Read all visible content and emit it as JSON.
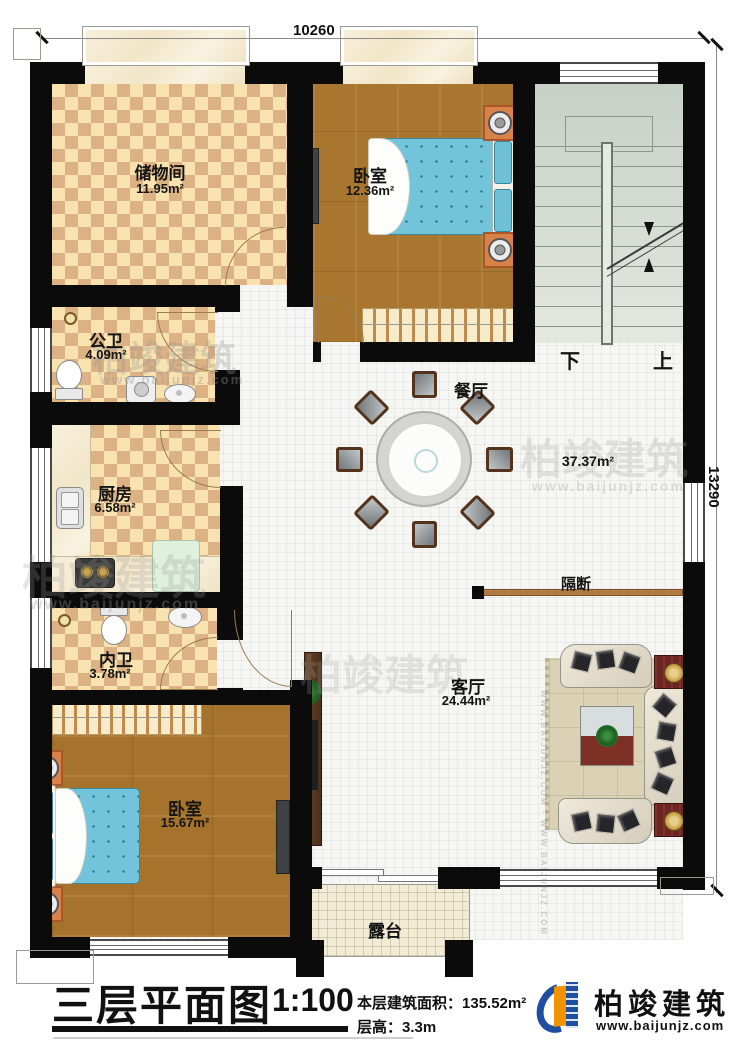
{
  "dimensions": {
    "top": "10260",
    "right": "13290"
  },
  "rooms": {
    "storage": {
      "name": "储物间",
      "area": "11.95m²"
    },
    "bedroom_top": {
      "name": "卧室",
      "area": "12.36m²"
    },
    "public_bath": {
      "name": "公卫",
      "area": "4.09m²"
    },
    "kitchen": {
      "name": "厨房",
      "area": "6.58m²"
    },
    "inner_bath": {
      "name": "内卫",
      "area": "3.78m²"
    },
    "bedroom_bottom": {
      "name": "卧室",
      "area": "15.67m²"
    },
    "dining": {
      "name": "餐厅"
    },
    "living": {
      "name": "客厅",
      "area": "24.44m²"
    },
    "hall": {
      "area": "37.37m²"
    },
    "terrace": {
      "name": "露台"
    },
    "partition": {
      "name": "隔断"
    }
  },
  "stairs": {
    "down": "下",
    "up": "上"
  },
  "title_block": {
    "title": "三层平面图",
    "scale": "1:100",
    "area_label": "本层建筑面积：",
    "area_value": "135.52m²",
    "height_label": "层高：",
    "height_value": "3.3m"
  },
  "brand": {
    "name": "柏竣建筑",
    "website": "www.baijunjz.com"
  },
  "watermark": {
    "name": "柏竣建筑",
    "website": "www.baijunjz.com",
    "vertical": "WWW.BAIJUNJZ.COM · WWW.BAIJUNJZ.COM"
  }
}
